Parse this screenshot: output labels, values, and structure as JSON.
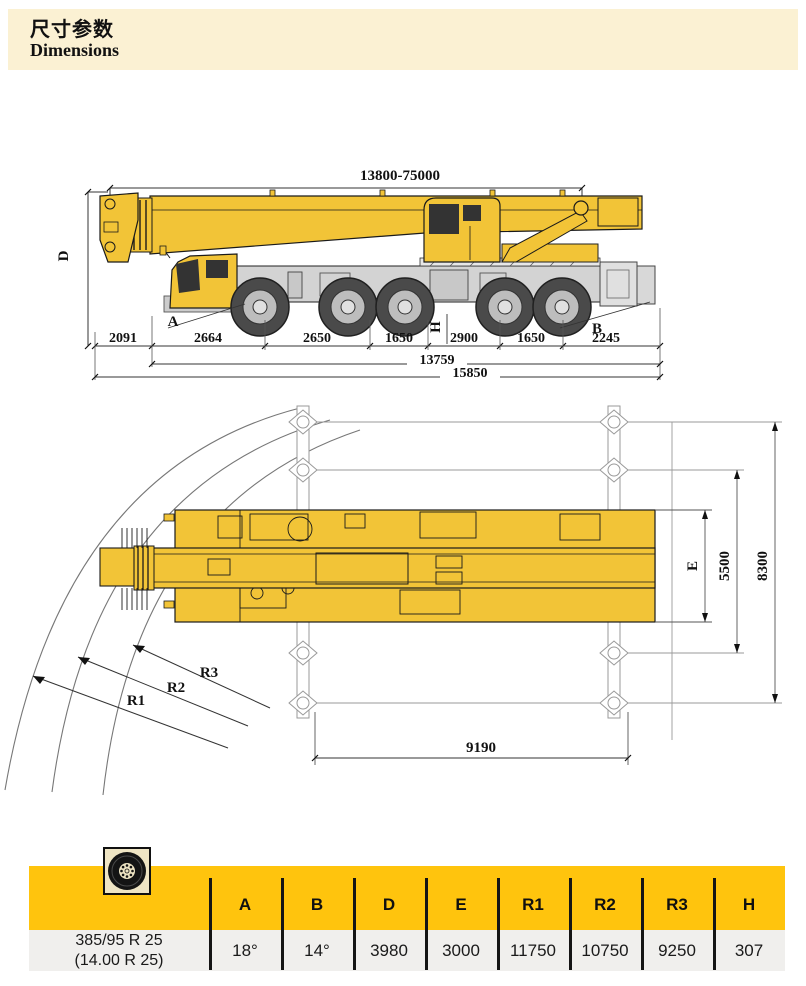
{
  "header": {
    "title_zh": "尺寸参数",
    "title_en": "Dimensions"
  },
  "side_view": {
    "boom_length_range": "13800-75000",
    "label_d": "D",
    "label_a": "A",
    "label_h": "H",
    "label_b": "B",
    "segment_dims": [
      "2091",
      "2664",
      "2650",
      "1650",
      "2900",
      "1650",
      "2245"
    ],
    "dim_13759": "13759",
    "dim_15850": "15850"
  },
  "top_view": {
    "label_e": "E",
    "dim_5500": "5500",
    "dim_8300": "8300",
    "label_r1": "R1",
    "label_r2": "R2",
    "label_r3": "R3",
    "dim_9190": "9190"
  },
  "table": {
    "tire_icon": "tire-icon",
    "columns": [
      "A",
      "B",
      "D",
      "E",
      "R1",
      "R2",
      "R3",
      "H"
    ],
    "tyre_label_line1": "385/95 R 25",
    "tyre_label_line2": "(14.00 R 25)",
    "values": [
      "18°",
      "14°",
      "3980",
      "3000",
      "11750",
      "10750",
      "9250",
      "307"
    ]
  },
  "colors": {
    "accent_yellow": "#FFC40D",
    "crane_yellow": "#F2C437",
    "header_cream": "#FBF1D3",
    "row_gray": "#F0EFED"
  }
}
